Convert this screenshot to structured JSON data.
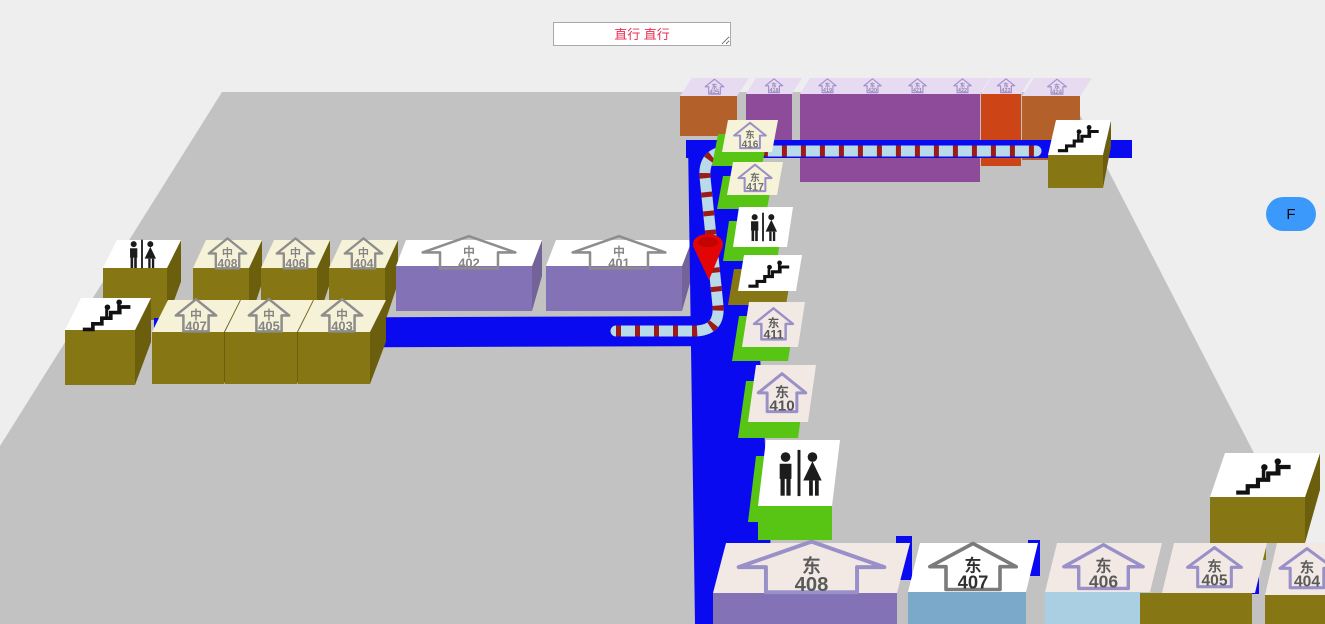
{
  "directions_box": {
    "value": "直行 直行",
    "text_color": "#ea2d55"
  },
  "floor_button": {
    "label": "F",
    "bg": "#3b99fc"
  },
  "map": {
    "background": "#eeeeee",
    "floor": {
      "fill": "#c2c2c2",
      "points": [
        [
          222,
          92
        ],
        [
          1068,
          92
        ],
        [
          1325,
          591
        ],
        [
          1325,
          624
        ],
        [
          0,
          624
        ],
        [
          0,
          446
        ]
      ]
    },
    "road_color": "#0a0af0",
    "roads": [
      {
        "name": "corridor-road-top",
        "points": [
          [
            686,
            140
          ],
          [
            1132,
            140
          ],
          [
            1132,
            158
          ],
          [
            686,
            158
          ]
        ]
      },
      {
        "name": "corridor-road-vertical",
        "points": [
          [
            688,
            140
          ],
          [
            748,
            140
          ],
          [
            775,
            624
          ],
          [
            695,
            624
          ]
        ]
      },
      {
        "name": "corridor-road-left",
        "points": [
          [
            154,
            318
          ],
          [
            745,
            316
          ],
          [
            745,
            346
          ],
          [
            154,
            348
          ]
        ]
      },
      {
        "name": "corridor-road-gap-1",
        "points": [
          [
            896,
            536
          ],
          [
            912,
            536
          ],
          [
            912,
            580
          ],
          [
            896,
            580
          ]
        ]
      },
      {
        "name": "corridor-road-gap-2",
        "points": [
          [
            1028,
            540
          ],
          [
            1040,
            540
          ],
          [
            1040,
            576
          ],
          [
            1028,
            576
          ]
        ]
      },
      {
        "name": "ledge-olive",
        "points": [
          [
            1233,
            530
          ],
          [
            1266,
            530
          ],
          [
            1266,
            560
          ],
          [
            1233,
            560
          ]
        ],
        "fill": "#877714"
      },
      {
        "name": "corridor-road-gap-3",
        "points": [
          [
            1242,
            558
          ],
          [
            1259,
            558
          ],
          [
            1259,
            594
          ],
          [
            1242,
            594
          ]
        ]
      }
    ],
    "route": {
      "path": "M 616 331 L 694 331 Q 720 331 718 306 L 705 177 Q 703 152 729 151 L 1036 151",
      "tube_color": "#b9dae8",
      "stripe_color": "#9b1b1b",
      "width": 11,
      "dash": "5 14"
    },
    "pin": {
      "cx": 708,
      "cy": 244,
      "color": "#e20505"
    },
    "boxes": [
      {
        "layer": 1,
        "name": "room-east-425",
        "kind": "room",
        "label": [
          "东",
          "425"
        ],
        "top": {
          "x": 680,
          "y": 78,
          "w": 57,
          "h": 18,
          "lean": 12,
          "fill": "#e6dbf0"
        },
        "front": {
          "fh": 40,
          "fill": "#b4602a"
        },
        "icon": {
          "s": 13,
          "outline": "#a98fd0",
          "text": "#8f86b5"
        }
      },
      {
        "layer": 1,
        "name": "room-east-418",
        "kind": "room",
        "label": [
          "东",
          "418"
        ],
        "top": {
          "x": 746,
          "y": 78,
          "w": 46,
          "h": 16,
          "lean": 10,
          "fill": "#e6dbf0"
        },
        "front": {
          "fh": 58,
          "fill": "#8e4b99"
        },
        "icon": {
          "s": 12,
          "outline": "#a98fd0",
          "text": "#8f86b5"
        }
      },
      {
        "layer": 1,
        "name": "room-east-419",
        "kind": "room",
        "label": [
          "东",
          "419"
        ],
        "top": {
          "x": 800,
          "y": 78,
          "w": 45,
          "h": 16,
          "lean": 10,
          "fill": "#e6dbf0"
        },
        "front": {
          "fh": 88,
          "fill": "#8e4b99"
        },
        "icon": {
          "s": 12,
          "outline": "#a98fd0",
          "text": "#8f86b5"
        }
      },
      {
        "layer": 1,
        "name": "room-east-420",
        "kind": "room",
        "label": [
          "东",
          "420"
        ],
        "top": {
          "x": 845,
          "y": 78,
          "w": 45,
          "h": 16,
          "lean": 10,
          "fill": "#e6dbf0"
        },
        "front": {
          "fh": 88,
          "fill": "#8e4b99"
        },
        "icon": {
          "s": 12,
          "outline": "#a98fd0",
          "text": "#8f86b5"
        }
      },
      {
        "layer": 1,
        "name": "room-east-421",
        "kind": "room",
        "label": [
          "东",
          "421"
        ],
        "top": {
          "x": 890,
          "y": 78,
          "w": 45,
          "h": 16,
          "lean": 10,
          "fill": "#e6dbf0"
        },
        "front": {
          "fh": 88,
          "fill": "#8e4b99"
        },
        "icon": {
          "s": 12,
          "outline": "#a98fd0",
          "text": "#8f86b5"
        }
      },
      {
        "layer": 1,
        "name": "room-east-422",
        "kind": "room",
        "label": [
          "东",
          "422"
        ],
        "top": {
          "x": 935,
          "y": 78,
          "w": 45,
          "h": 16,
          "lean": 10,
          "fill": "#e6dbf0"
        },
        "front": {
          "fh": 88,
          "fill": "#8e4b99"
        },
        "icon": {
          "s": 12,
          "outline": "#a98fd0",
          "text": "#8f86b5"
        }
      },
      {
        "layer": 1,
        "name": "room-east-423",
        "kind": "room",
        "label": [
          "东",
          "423"
        ],
        "top": {
          "x": 981,
          "y": 78,
          "w": 40,
          "h": 16,
          "lean": 10,
          "fill": "#e6dbf0"
        },
        "front": {
          "fh": 72,
          "fill": "#cd4517"
        },
        "icon": {
          "s": 12,
          "outline": "#a98fd0",
          "text": "#8f86b5"
        }
      },
      {
        "layer": 1,
        "name": "room-east-424",
        "kind": "room",
        "label": [
          "东",
          "424"
        ],
        "top": {
          "x": 1022,
          "y": 78,
          "w": 58,
          "h": 18,
          "lean": 12,
          "fill": "#e6dbf0"
        },
        "front": {
          "fh": 64,
          "fill": "#b4602a"
        },
        "icon": {
          "s": 13,
          "outline": "#a98fd0",
          "text": "#8f86b5"
        }
      },
      {
        "layer": 1,
        "name": "toilet-box-center",
        "kind": "toilet",
        "top": {
          "x": 103,
          "y": 240,
          "w": 64,
          "h": 28,
          "lean": 14,
          "fill": "#ffffff"
        },
        "front": {
          "fh": 52,
          "fill": "#877714"
        },
        "side": {
          "fill": "#6b5e0c"
        },
        "icon": {
          "s": 26
        }
      },
      {
        "layer": 1,
        "name": "room-center-408",
        "kind": "room",
        "label": [
          "中",
          "408"
        ],
        "top": {
          "x": 193,
          "y": 240,
          "w": 56,
          "h": 28,
          "lean": 13,
          "fill": "#f6f2d7"
        },
        "front": {
          "fh": 54,
          "fill": "#877714"
        },
        "side": {
          "fill": "#6b5e0c"
        },
        "icon": {
          "s": 26,
          "outline": "#8d8d8d",
          "text": "#858585"
        }
      },
      {
        "layer": 1,
        "name": "room-center-406",
        "kind": "room",
        "label": [
          "中",
          "406"
        ],
        "top": {
          "x": 261,
          "y": 240,
          "w": 56,
          "h": 28,
          "lean": 13,
          "fill": "#f6f2d7"
        },
        "front": {
          "fh": 54,
          "fill": "#877714"
        },
        "side": {
          "fill": "#6b5e0c"
        },
        "icon": {
          "s": 26,
          "outline": "#8d8d8d",
          "text": "#858585"
        }
      },
      {
        "layer": 1,
        "name": "room-center-404",
        "kind": "room",
        "label": [
          "中",
          "404"
        ],
        "top": {
          "x": 329,
          "y": 240,
          "w": 56,
          "h": 28,
          "lean": 13,
          "fill": "#f6f2d7"
        },
        "front": {
          "fh": 54,
          "fill": "#877714"
        },
        "side": {
          "fill": "#6b5e0c"
        },
        "icon": {
          "s": 26,
          "outline": "#8d8d8d",
          "text": "#858585"
        }
      },
      {
        "layer": 1,
        "name": "room-center-402",
        "kind": "room",
        "label": [
          "中",
          "402"
        ],
        "top": {
          "x": 396,
          "y": 240,
          "w": 136,
          "h": 26,
          "lean": 10,
          "fill": "#ffffff"
        },
        "front": {
          "fh": 45,
          "fill": "#8472b6"
        },
        "side": {
          "fill": "#746399"
        },
        "icon": {
          "s": 28,
          "sx": 2.3,
          "outline": "#8d8d8d",
          "text": "#858585"
        }
      },
      {
        "layer": 1,
        "name": "room-center-401",
        "kind": "room",
        "label": [
          "中",
          "401"
        ],
        "top": {
          "x": 546,
          "y": 240,
          "w": 136,
          "h": 26,
          "lean": 10,
          "fill": "#ffffff"
        },
        "front": {
          "fh": 45,
          "fill": "#8472b6"
        },
        "side": {
          "fill": "#746399"
        },
        "icon": {
          "s": 28,
          "sx": 2.3,
          "outline": "#8d8d8d",
          "text": "#858585"
        }
      },
      {
        "layer": 2,
        "name": "stairs-box-center",
        "kind": "stairs",
        "top": {
          "x": 65,
          "y": 298,
          "w": 70,
          "h": 32,
          "lean": 16,
          "fill": "#ffffff"
        },
        "front": {
          "fh": 55,
          "fill": "#877714"
        },
        "side": {
          "fill": "#6b5e0c"
        },
        "icon": {
          "s": 28
        }
      },
      {
        "layer": 2,
        "name": "room-center-407",
        "kind": "room",
        "label": [
          "中",
          "407"
        ],
        "top": {
          "x": 152,
          "y": 300,
          "w": 72,
          "h": 32,
          "lean": 16,
          "fill": "#f6f2d7"
        },
        "front": {
          "fh": 52,
          "fill": "#877714"
        },
        "side": {
          "fill": "#6b5e0c"
        },
        "icon": {
          "s": 28,
          "outline": "#8d8d8d",
          "text": "#858585"
        }
      },
      {
        "layer": 2,
        "name": "room-center-405",
        "kind": "room",
        "label": [
          "中",
          "405"
        ],
        "top": {
          "x": 225,
          "y": 300,
          "w": 72,
          "h": 32,
          "lean": 16,
          "fill": "#f6f2d7"
        },
        "front": {
          "fh": 52,
          "fill": "#877714"
        },
        "side": {
          "fill": "#6b5e0c"
        },
        "icon": {
          "s": 28,
          "outline": "#8d8d8d",
          "text": "#858585"
        }
      },
      {
        "layer": 2,
        "name": "room-center-403",
        "kind": "room",
        "label": [
          "中",
          "403"
        ],
        "top": {
          "x": 298,
          "y": 300,
          "w": 72,
          "h": 32,
          "lean": 16,
          "fill": "#f6f2d7"
        },
        "front": {
          "fh": 52,
          "fill": "#877714"
        },
        "side": {
          "fill": "#6b5e0c"
        },
        "icon": {
          "s": 28,
          "outline": "#8d8d8d",
          "text": "#858585"
        }
      },
      {
        "layer": 2,
        "name": "stairs-box-top-right",
        "kind": "stairs",
        "top": {
          "x": 1048,
          "y": 120,
          "w": 55,
          "h": 35,
          "lean": 8,
          "fill": "#ffffff"
        },
        "front": {
          "fh": 33,
          "fill": "#877714"
        },
        "side": {
          "fill": "#6b5e0c"
        },
        "icon": {
          "s": 24
        }
      },
      {
        "layer": 2,
        "name": "room-east-416",
        "kind": "room",
        "label": [
          "东",
          "416"
        ],
        "top": {
          "x": 722,
          "y": 120,
          "w": 50,
          "h": 32,
          "lean": 6,
          "fill": "#f7f3d8"
        },
        "base": {
          "dx": -10,
          "dy": 14,
          "fill": "#58c414"
        },
        "icon": {
          "s": 22,
          "outline": "#9a90c8",
          "text": "#6f6f6f"
        }
      },
      {
        "layer": 2,
        "name": "room-east-417",
        "kind": "room",
        "label": [
          "东",
          "417"
        ],
        "top": {
          "x": 727,
          "y": 162,
          "w": 50,
          "h": 33,
          "lean": 6,
          "fill": "#f7f3d8"
        },
        "base": {
          "dx": -10,
          "dy": 14,
          "fill": "#58c414"
        },
        "icon": {
          "s": 23,
          "outline": "#9a90c8",
          "text": "#6f6f6f"
        }
      },
      {
        "layer": 2,
        "name": "toilet-box-east-upper",
        "kind": "toilet",
        "top": {
          "x": 733,
          "y": 207,
          "w": 54,
          "h": 40,
          "lean": 6,
          "fill": "#ffffff"
        },
        "base": {
          "dx": -10,
          "dy": 14,
          "fill": "#58c414"
        },
        "icon": {
          "s": 26
        }
      },
      {
        "layer": 2,
        "name": "stairs-box-east",
        "kind": "stairs",
        "top": {
          "x": 738,
          "y": 255,
          "w": 58,
          "h": 36,
          "lean": 6,
          "fill": "#ffffff"
        },
        "base": {
          "dx": -10,
          "dy": 14,
          "fill": "#877714"
        },
        "icon": {
          "s": 24
        }
      },
      {
        "layer": 2,
        "name": "room-east-411",
        "kind": "room",
        "label": [
          "东",
          "411"
        ],
        "top": {
          "x": 742,
          "y": 302,
          "w": 56,
          "h": 45,
          "lean": 7,
          "fill": "#f2e9e4"
        },
        "base": {
          "dx": -10,
          "dy": 14,
          "fill": "#58c414"
        },
        "icon": {
          "s": 27,
          "outline": "#9a90c8",
          "text": "#565656"
        }
      },
      {
        "layer": 2,
        "name": "room-east-410",
        "kind": "room",
        "label": [
          "东",
          "410"
        ],
        "top": {
          "x": 748,
          "y": 365,
          "w": 60,
          "h": 57,
          "lean": 8,
          "fill": "#f2e9e4"
        },
        "base": {
          "dx": -10,
          "dy": 16,
          "fill": "#58c414"
        },
        "icon": {
          "s": 33,
          "outline": "#9a90c8",
          "text": "#565656"
        }
      },
      {
        "layer": 2,
        "name": "toilet-box-east-lower",
        "kind": "toilet",
        "top": {
          "x": 758,
          "y": 440,
          "w": 74,
          "h": 66,
          "lean": 8,
          "fill": "#ffffff"
        },
        "base": {
          "dx": -10,
          "dy": 16,
          "fill": "#58c414"
        },
        "front": {
          "fh": 34,
          "fill": "#58c414"
        },
        "icon": {
          "s": 42
        }
      },
      {
        "layer": 2,
        "name": "stairs-box-bottom-right",
        "kind": "stairs",
        "top": {
          "x": 1210,
          "y": 453,
          "w": 95,
          "h": 44,
          "lean": 15,
          "fill": "#ffffff"
        },
        "front": {
          "fh": 46,
          "fill": "#877714"
        },
        "side": {
          "fill": "#6b5e0c"
        },
        "icon": {
          "s": 32
        }
      },
      {
        "layer": 2,
        "name": "room-east-408",
        "kind": "room",
        "label": [
          "东",
          "408"
        ],
        "top": {
          "x": 713,
          "y": 543,
          "w": 184,
          "h": 50,
          "lean": 13,
          "fill": "#f2e8e4"
        },
        "front": {
          "fh": 31,
          "fill": "#8472b6"
        },
        "icon": {
          "s": 44,
          "sx": 2.3,
          "outline": "#9a90c8",
          "text": "#5a5a5a"
        }
      },
      {
        "layer": 2,
        "name": "room-east-407",
        "kind": "room",
        "label": [
          "东",
          "407"
        ],
        "top": {
          "x": 908,
          "y": 543,
          "w": 118,
          "h": 49,
          "lean": 12,
          "fill": "#ffffff"
        },
        "front": {
          "fh": 33,
          "fill": "#7ba9c9"
        },
        "icon": {
          "s": 40,
          "sx": 1.5,
          "outline": "#7b7b7b",
          "text": "#303030"
        }
      },
      {
        "layer": 2,
        "name": "room-east-406",
        "kind": "room",
        "label": [
          "东",
          "406"
        ],
        "top": {
          "x": 1045,
          "y": 543,
          "w": 105,
          "h": 49,
          "lean": 12,
          "fill": "#f2e8e4"
        },
        "front": {
          "fh": 33,
          "fill": "#abcfe2"
        },
        "icon": {
          "s": 38,
          "sx": 1.45,
          "outline": "#9a90c8",
          "text": "#5a5a5a"
        }
      },
      {
        "layer": 2,
        "name": "room-east-405",
        "kind": "room",
        "label": [
          "东",
          "405"
        ],
        "top": {
          "x": 1162,
          "y": 543,
          "w": 93,
          "h": 50,
          "lean": 12,
          "fill": "#f2e8e4"
        },
        "front": {
          "dx": -22,
          "w": 112,
          "fh": 31,
          "fill": "#877714"
        },
        "icon": {
          "s": 34,
          "sx": 1.1,
          "outline": "#9a90c8",
          "text": "#5a5a5a"
        }
      },
      {
        "layer": 2,
        "name": "room-east-404",
        "kind": "room",
        "label": [
          "东",
          "404"
        ],
        "top": {
          "x": 1265,
          "y": 543,
          "w": 72,
          "h": 52,
          "lean": 12,
          "fill": "#f2e8e4"
        },
        "front": {
          "fh": 29,
          "fill": "#877714"
        },
        "icon": {
          "s": 34,
          "sx": 1.1,
          "outline": "#9a90c8",
          "text": "#5a5a5a"
        }
      }
    ]
  }
}
